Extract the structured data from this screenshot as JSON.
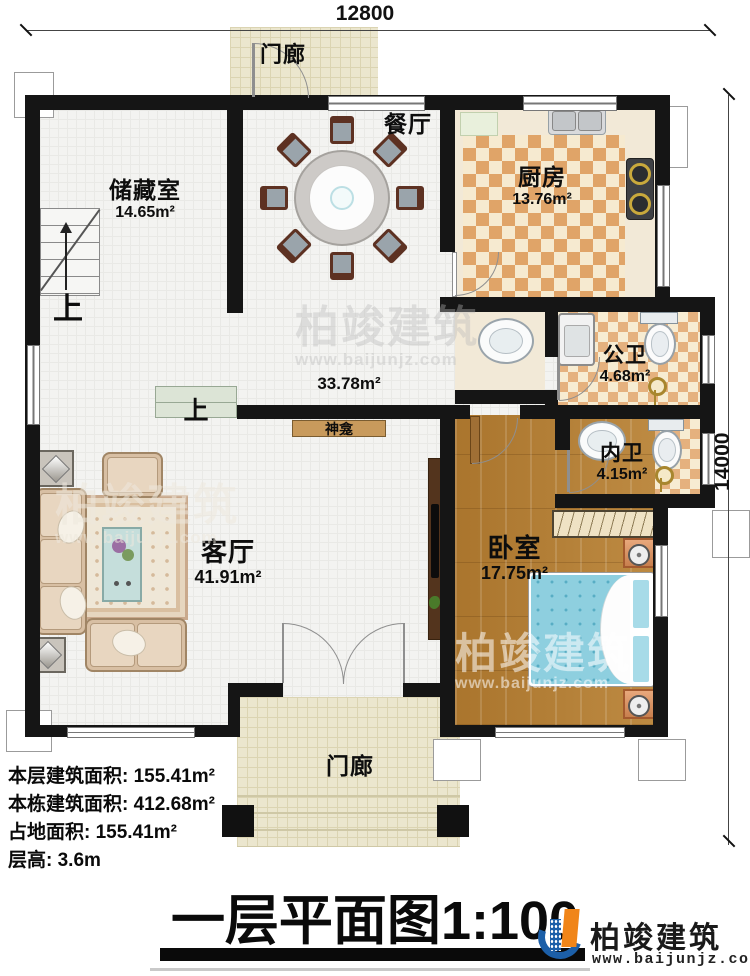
{
  "dimensions": {
    "top": "12800",
    "right": "14000"
  },
  "rooms": {
    "porch_top": {
      "name": "门廊"
    },
    "storage": {
      "name": "储藏室",
      "area": "14.65m²"
    },
    "dining": {
      "name": "餐厅"
    },
    "kitchen": {
      "name": "厨房",
      "area": "13.76m²"
    },
    "hall": {
      "area": "33.78m²"
    },
    "public_bath": {
      "name": "公卫",
      "area": "4.68m²"
    },
    "private_bath": {
      "name": "内卫",
      "area": "4.15m²"
    },
    "living": {
      "name": "客厅",
      "area": "41.91m²"
    },
    "bedroom": {
      "name": "卧室",
      "area": "17.75m²"
    },
    "shrine": {
      "name": "神龛"
    },
    "porch_bottom": {
      "name": "门廊"
    }
  },
  "stairs": {
    "up": "上"
  },
  "stats": [
    {
      "label": "本层建筑面积:",
      "value": "155.41m²"
    },
    {
      "label": "本栋建筑面积:",
      "value": "412.68m²"
    },
    {
      "label": "占地面积:",
      "value": "155.41m²"
    },
    {
      "label": "层高:",
      "value": "3.6m"
    }
  ],
  "title": {
    "name": "一层平面图",
    "scale": "1:100"
  },
  "branding": {
    "company": "柏竣建筑",
    "website": "www.baijunjz.com"
  },
  "watermark": {
    "company": "柏竣建筑",
    "website": "www.baijunjz.com"
  },
  "colors": {
    "wall": "#151515",
    "kitchen_floor": "#e0a468",
    "bath_floor": "#e5b17e",
    "wood_floor": "#b07c35",
    "bed": "#8ecfdf",
    "porch_floor": "#ebe6ce",
    "shrine": "#c89a5c",
    "logo_blue": "#1c5fa8",
    "logo_orange": "#f08519"
  }
}
